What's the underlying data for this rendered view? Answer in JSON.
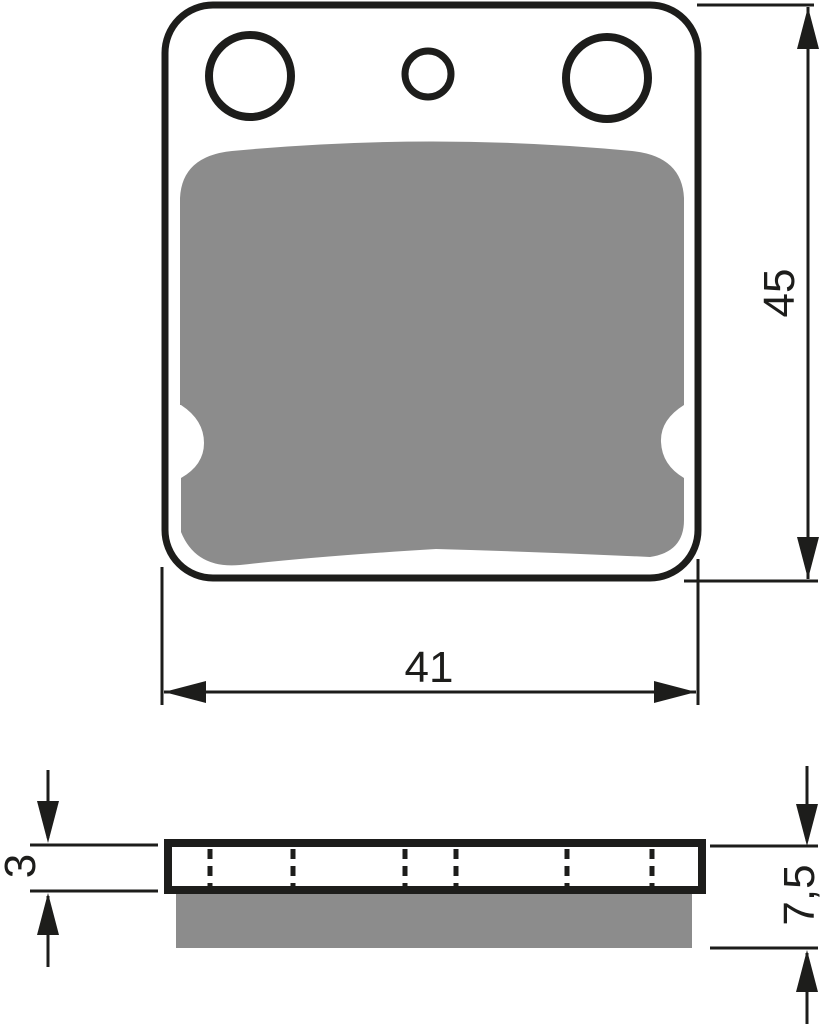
{
  "colors": {
    "line": "#1d1d1b",
    "friction_material": "#8c8c8c",
    "background": "#ffffff"
  },
  "front_view": {
    "width_dimension_label": "41",
    "height_dimension_label": "45"
  },
  "side_view": {
    "backing_plate_thickness_label": "3",
    "total_thickness_label": "7,5"
  }
}
